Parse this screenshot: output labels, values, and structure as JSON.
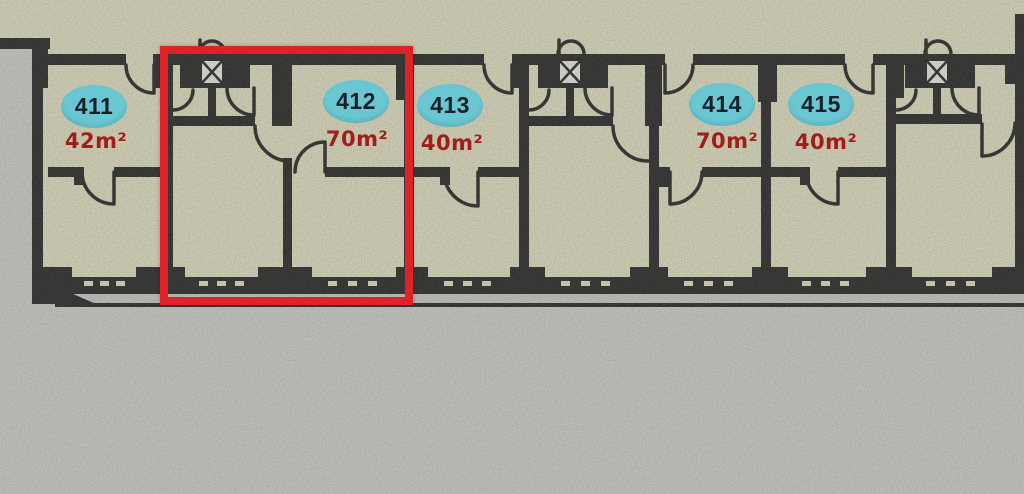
{
  "floorplan": {
    "units": [
      {
        "number": "411",
        "area": "42m²",
        "highlighted": false
      },
      {
        "number": "412",
        "area": "70m²",
        "highlighted": true
      },
      {
        "number": "413",
        "area": "40m²",
        "highlighted": false
      },
      {
        "number": "414",
        "area": "70m²",
        "highlighted": false
      },
      {
        "number": "415",
        "area": "40m²",
        "highlighted": false
      }
    ],
    "highlighted_unit": "412",
    "icons": {
      "elevator_shaft": "box-with-x",
      "door_swing": "quarter-arc",
      "window": "ticked-band"
    },
    "colors": {
      "background": "#dcdbd7",
      "room_fill": "#f0eecd",
      "wall": "#1c1c1c",
      "badge_fill": "#6ac7d2",
      "badge_text": "#1a1f29",
      "area_text": "#a01d18",
      "highlight_box": "#de2228",
      "balcony_fill": "#d7d6d2"
    }
  }
}
